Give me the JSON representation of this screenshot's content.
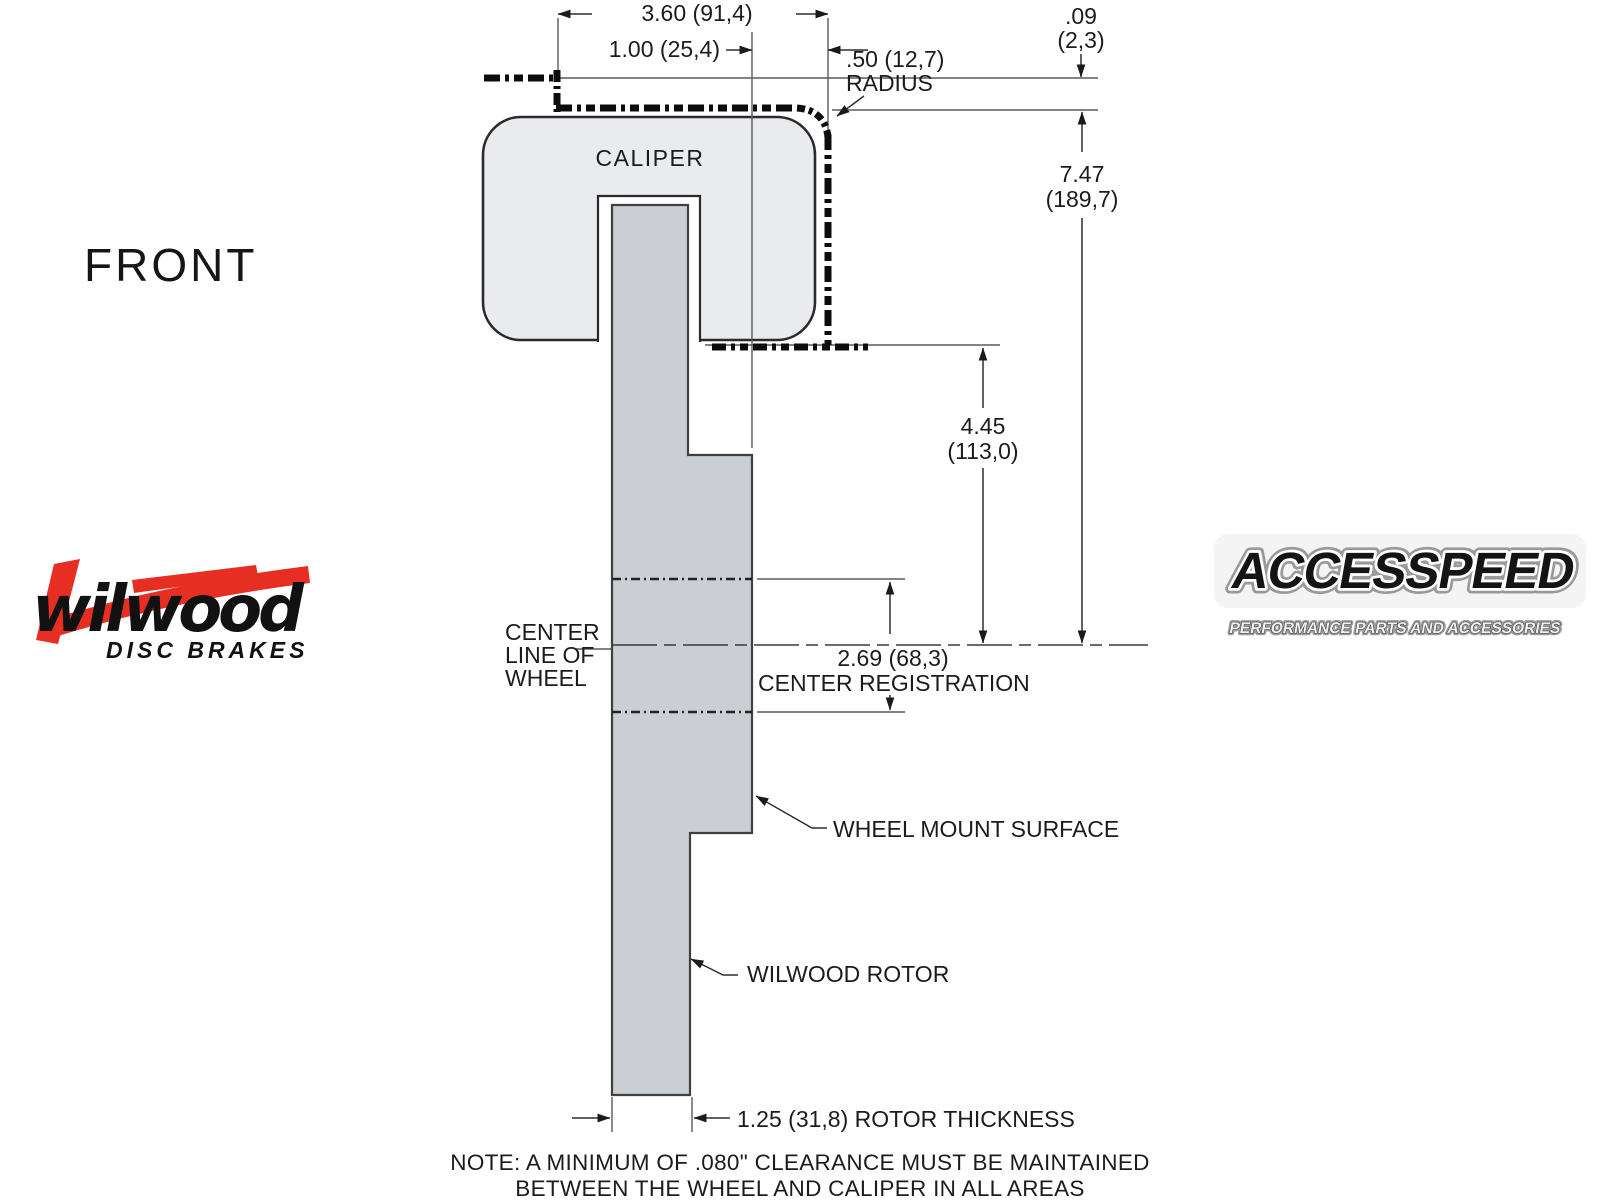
{
  "view_label": "FRONT",
  "logos": {
    "wilwood": {
      "wordmark": "wilwood",
      "tagline": "DISC BRAKES",
      "accent_color": "#e62e22",
      "text_color": "#111111"
    },
    "accesspeed": {
      "wordmark": "ACCESSPEED",
      "tagline": "PERFORMANCE PARTS AND ACCESSORIES"
    }
  },
  "diagram": {
    "part_labels": {
      "caliper": "CALIPER",
      "center_line_1": "CENTER",
      "center_line_2": "LINE OF",
      "center_line_3": "WHEEL",
      "center_registration": "CENTER REGISTRATION",
      "wheel_mount_surface": "WHEEL MOUNT SURFACE",
      "rotor": "WILWOOD ROTOR",
      "radius_label": "RADIUS"
    },
    "dimensions": {
      "overall_width": "3.60 (91,4)",
      "mount_offset": "1.00 (25,4)",
      "corner_radius": ".50 (12,7)",
      "wheel_clearance_in": ".09",
      "wheel_clearance_mm": "(2,3)",
      "overall_height_in": "7.47",
      "overall_height_mm": "(189,7)",
      "caliper_to_centerline_in": "4.45",
      "caliper_to_centerline_mm": "(113,0)",
      "center_registration": "2.69 (68,3)",
      "rotor_thickness": "1.25 (31,8) ROTOR THICKNESS"
    },
    "note_line_1": "NOTE: A MINIMUM OF .080\" CLEARANCE MUST BE MAINTAINED",
    "note_line_2": "BETWEEN THE WHEEL AND CALIPER IN ALL AREAS",
    "colors": {
      "caliper_fill": "#e9ebee",
      "rotor_fill": "#cbcfd3"
    }
  }
}
